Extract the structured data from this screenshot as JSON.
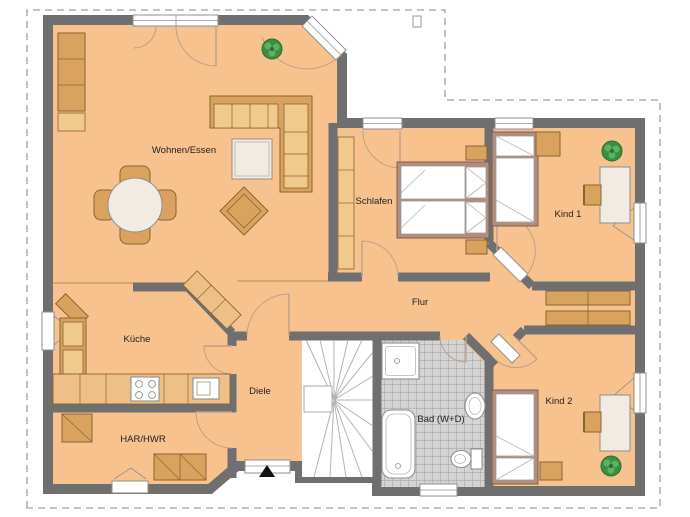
{
  "title": "Erdgeschoss Grundriss",
  "rooms": [
    {
      "id": "wohnen",
      "label": "Wohnen/Essen"
    },
    {
      "id": "schlafen",
      "label": "Schlafen"
    },
    {
      "id": "kind1",
      "label": "Kind 1"
    },
    {
      "id": "flur",
      "label": "Flur"
    },
    {
      "id": "kueche",
      "label": "Küche"
    },
    {
      "id": "diele",
      "label": "Diele"
    },
    {
      "id": "har",
      "label": "HAR/HWR"
    },
    {
      "id": "bad",
      "label": "Bad (W+D)"
    },
    {
      "id": "kind2",
      "label": "Kind 2"
    }
  ],
  "icons": [
    {
      "name": "entrance-arrow",
      "meaning": "main entrance direction"
    },
    {
      "name": "plant-icon",
      "meaning": "potted plant",
      "count": 3
    },
    {
      "name": "site-marker",
      "meaning": "small survey marker on plot boundary"
    }
  ],
  "colors": {
    "floor": "#f7c28d",
    "wall": "#6f6f6f",
    "boundary": "#a0a0a0",
    "wood": "#d9a35f",
    "wood_light": "#f0c98c",
    "wood_dark": "#8a6430",
    "counter": "#eec088",
    "bedframe": "#b58d7b",
    "table": "#f1ebe1",
    "tile": "#d4d4d4",
    "tile_line": "#9b9b9b",
    "fixture_line": "#8f8f8f",
    "door_arc": "#bda089",
    "plant": "#3c8f42",
    "plant_dark": "#2b6b31",
    "label": "#1f1f1f"
  }
}
